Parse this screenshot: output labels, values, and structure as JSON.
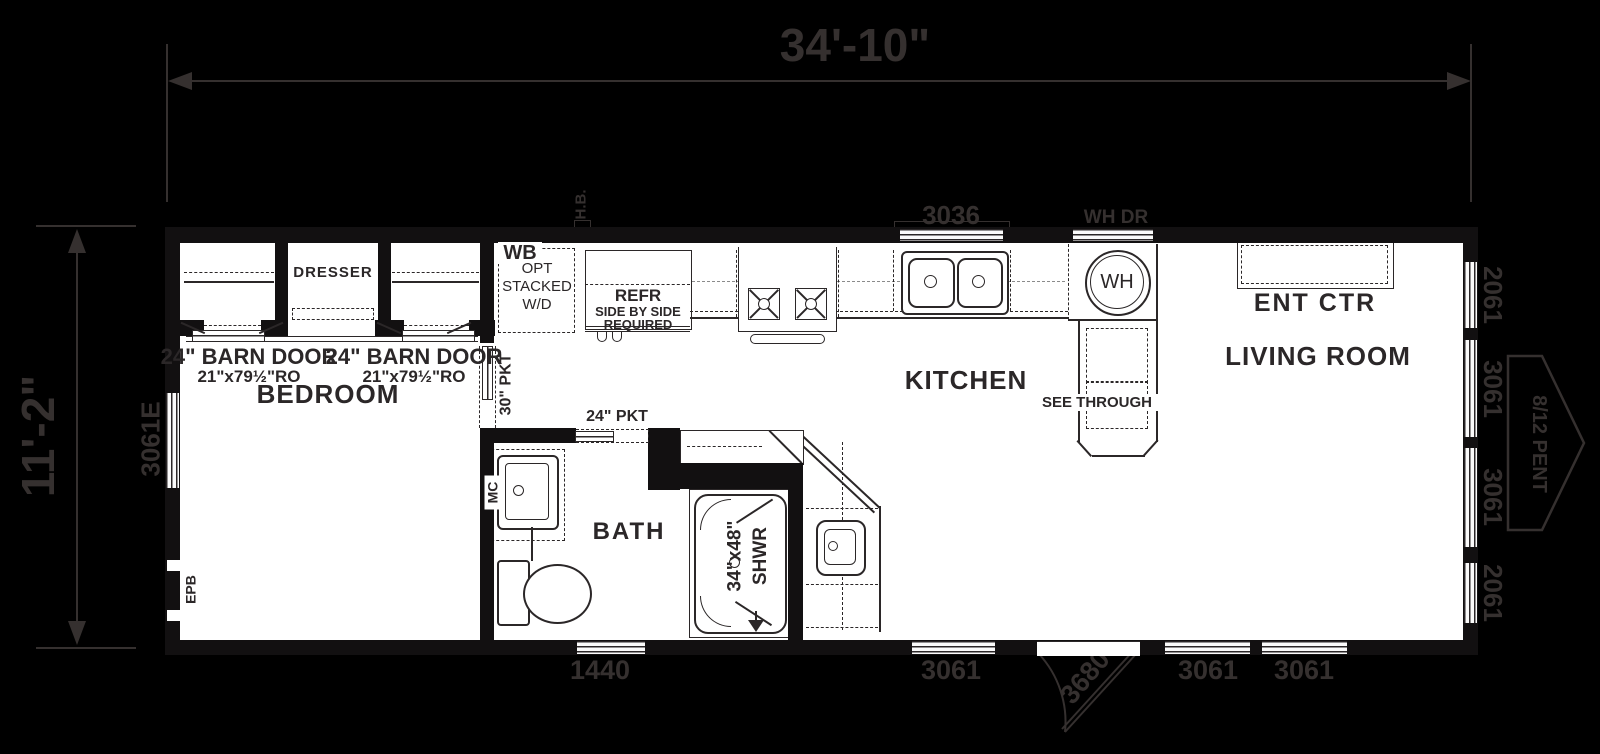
{
  "colors": {
    "background": "#000000",
    "wall": "#121011",
    "interior_line": "#2b2728",
    "exterior_line": "#35302f",
    "floor": "#ffffff"
  },
  "dimensions": {
    "width": "34'-10\"",
    "height": "11'-2\""
  },
  "exterior": {
    "hose_bib": "H.B.",
    "window_3036": "3036",
    "water_heater_door": "WH DR",
    "right_windows": [
      "2061",
      "3061",
      "3061",
      "2061"
    ],
    "roof_pent": "8/12 PENT",
    "left_window": "3061E",
    "bottom_window_1440": "1440",
    "bottom_windows": [
      "3061",
      "3061",
      "3061"
    ],
    "entry_door": "3680"
  },
  "rooms": {
    "bedroom": "BEDROOM",
    "bath": "BATH",
    "kitchen": "KITCHEN",
    "living_room": "LIVING ROOM"
  },
  "bedroom": {
    "dresser": "DRESSER",
    "barn_door": "24\" BARN DOOR",
    "barn_door_ro": "21\"x79½\"RO",
    "pocket_30": "30\" PKT",
    "epb": "EPB"
  },
  "utility": {
    "wb": "WB",
    "opt": "OPT",
    "stacked": "STACKED",
    "wd": "W/D"
  },
  "kitchen": {
    "refr": "REFR",
    "refr_line2": "SIDE BY SIDE",
    "refr_line3": "REQUIRED",
    "wh": "WH",
    "see_through": "SEE THROUGH",
    "ent_ctr": "ENT CTR"
  },
  "bath": {
    "pocket_24": "24\" PKT",
    "mc": "MC",
    "shower_size": "34\"x48\"",
    "shower": "SHWR"
  }
}
